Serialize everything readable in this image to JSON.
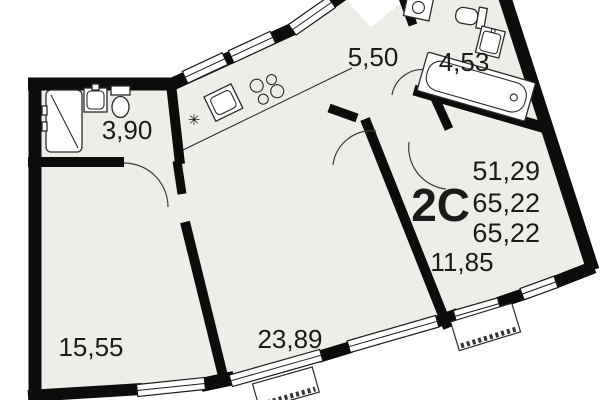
{
  "floorplan": {
    "unit_label": "2С",
    "summary": {
      "living_area": "51,29",
      "total_area": "65,22",
      "total_area_2": "65,22"
    },
    "rooms": [
      {
        "id": "bathroom-small",
        "area": "3,90"
      },
      {
        "id": "hallway",
        "area": "5,50"
      },
      {
        "id": "bathroom-large",
        "area": "4,53"
      },
      {
        "id": "room-left",
        "area": "15,55"
      },
      {
        "id": "living-kitchen",
        "area": "23,89"
      },
      {
        "id": "room-right",
        "area": "11,85"
      }
    ],
    "symbols": {
      "fridge": "✳"
    },
    "colors": {
      "wall": "#0c0c0c",
      "floor": "#edeee8",
      "background": "#ffffff",
      "text": "#1b1b1b"
    }
  }
}
